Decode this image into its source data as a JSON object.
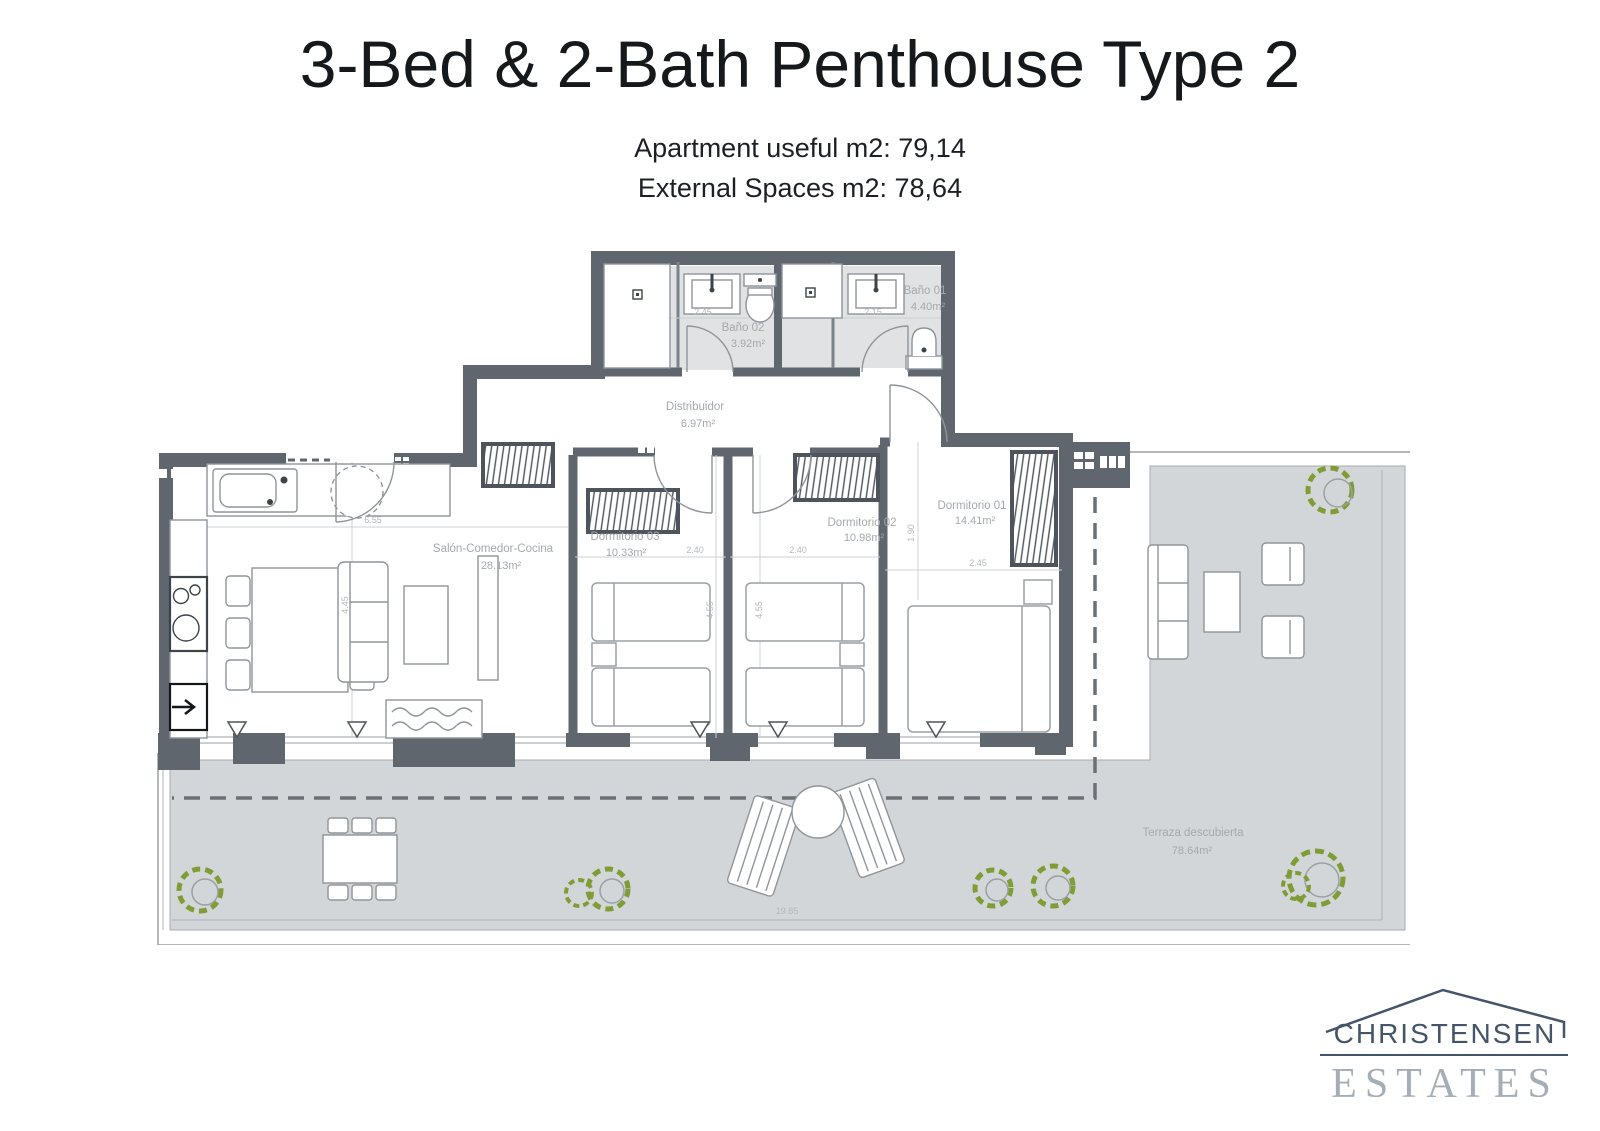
{
  "header": {
    "title": "3-Bed & 2-Bath Penthouse Type 2",
    "subtitle1": "Apartment useful m2: 79,14",
    "subtitle2": "External Spaces m2: 78,64"
  },
  "floorplan": {
    "rooms": [
      {
        "name": "Salón-Comedor-Cocina",
        "area": "28.13m²"
      },
      {
        "name": "Dormitorio 01",
        "area": "14.41m²"
      },
      {
        "name": "Dormitorio 02",
        "area": "10.98m²"
      },
      {
        "name": "Dormitorio 03",
        "area": "10.33m²"
      },
      {
        "name": "Baño 01",
        "area": "4.40m²"
      },
      {
        "name": "Baño 02",
        "area": "3.92m²"
      },
      {
        "name": "Distribuidor",
        "area": "6.97m²"
      },
      {
        "name": "Terraza descubierta",
        "area": "78.64m²"
      }
    ],
    "dimensions": {
      "bath2_width": "2.45",
      "bath1_width": "2.15",
      "bed3_width": "2.40",
      "bed2_width": "2.40",
      "bed1_width": "2.45",
      "living_width": "6.55",
      "living_depth": "4.45",
      "bed3_depth": "4.55",
      "bed2_depth": "4.55",
      "bed1_side": "1.90",
      "terrace_width": "19.85"
    },
    "colors": {
      "wall": "#5f666d",
      "terrace": "#d3d6d8",
      "bath_floor": "#e0e2e4",
      "plant": "#7f9c35"
    }
  },
  "logo": {
    "line1": "CHRISTENSEN",
    "line2": "ESTATES",
    "color_primary": "#44556a",
    "color_secondary": "#a5aeb7"
  }
}
